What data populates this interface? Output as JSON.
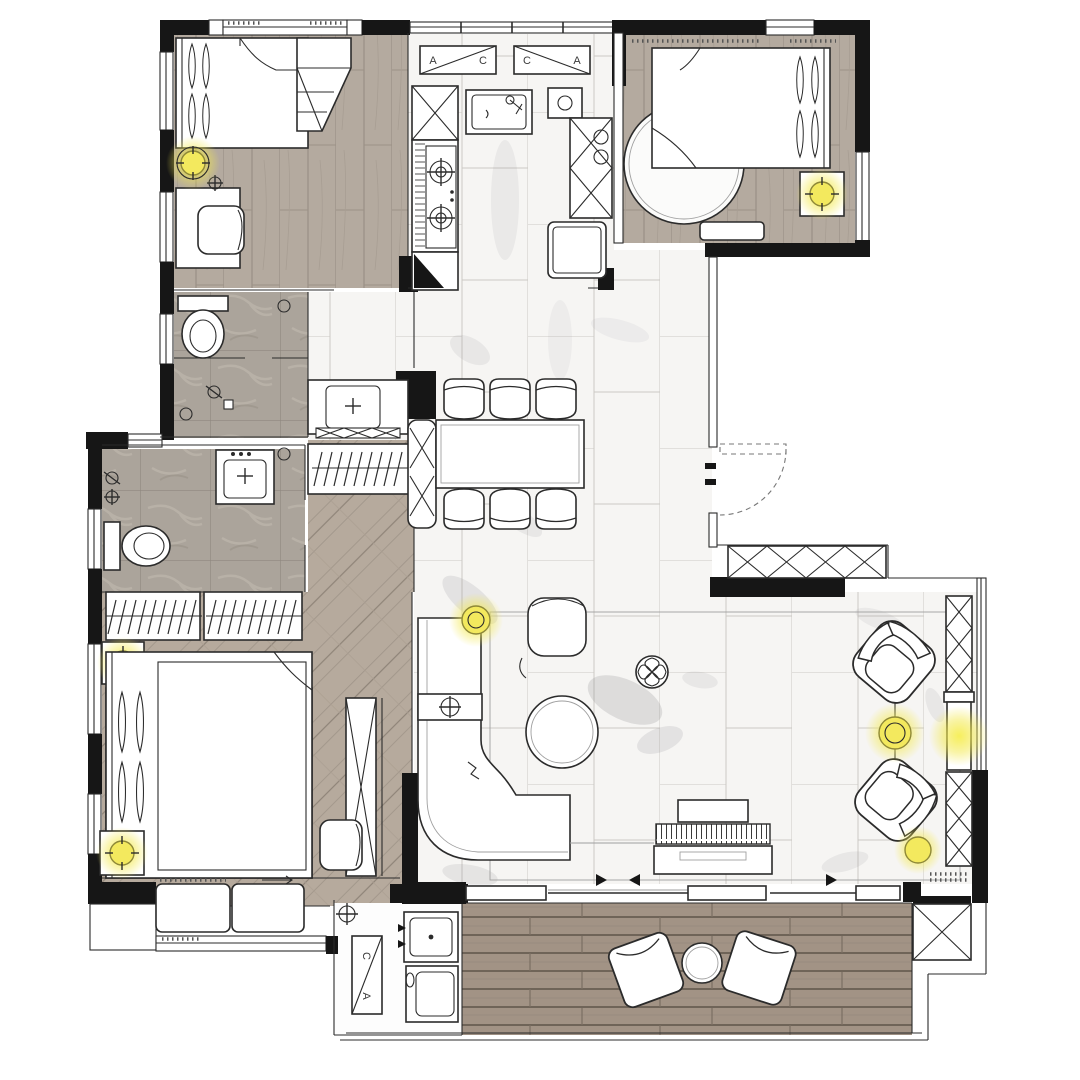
{
  "drawing": {
    "kind": "residential interior floor plan",
    "view": "top-down rendered plan"
  },
  "window_tags": {
    "kitchen_left": {
      "left": "A",
      "right": "C"
    },
    "kitchen_right": {
      "left": "C",
      "right": "A"
    },
    "laundry": {
      "top": "C",
      "bottom": "A"
    }
  },
  "colors": {
    "wall": "#161616",
    "line": "#2b2b2b",
    "wood_floor": "#b4aa9f",
    "chevron_floor": "#b6aa9d",
    "deck_floor": "#a29385",
    "marble_floor": "#f6f5f3",
    "stone_floor": "#aba49b",
    "light_glow": "#f3e94e",
    "paper": "#ffffff"
  },
  "rooms": [
    {
      "name": "bedroom-top-left",
      "floor": "wood-plank"
    },
    {
      "name": "kitchen",
      "floor": "marble-tile"
    },
    {
      "name": "master-bedroom-top-right",
      "floor": "wood-plank"
    },
    {
      "name": "bathroom-upper",
      "floor": "stone-tile"
    },
    {
      "name": "vanity-hall",
      "floor": "marble-tile"
    },
    {
      "name": "bathroom-lower",
      "floor": "stone-tile"
    },
    {
      "name": "closet-corridor",
      "floor": "chevron-wood"
    },
    {
      "name": "bedroom-bottom-left",
      "floor": "chevron-wood"
    },
    {
      "name": "dining-area",
      "floor": "marble-tile"
    },
    {
      "name": "living-area",
      "floor": "marble-tile"
    },
    {
      "name": "entry-foyer",
      "floor": "plain"
    },
    {
      "name": "laundry-nook",
      "floor": "plain"
    },
    {
      "name": "balcony-deck",
      "floor": "wood-deck"
    }
  ],
  "lights": {
    "glow_color": "#f3e94e",
    "fixtures": [
      "bedroom-top-left-ceiling-lamp",
      "master-nightstand-lamp",
      "bedroom-bottom-left-nightstand-lamp-upper",
      "bedroom-bottom-left-nightstand-lamp-lower",
      "living-lamp-near-sofa",
      "living-lamp-between-armchairs",
      "display-niche-glow",
      "living-lamp-lower"
    ]
  }
}
